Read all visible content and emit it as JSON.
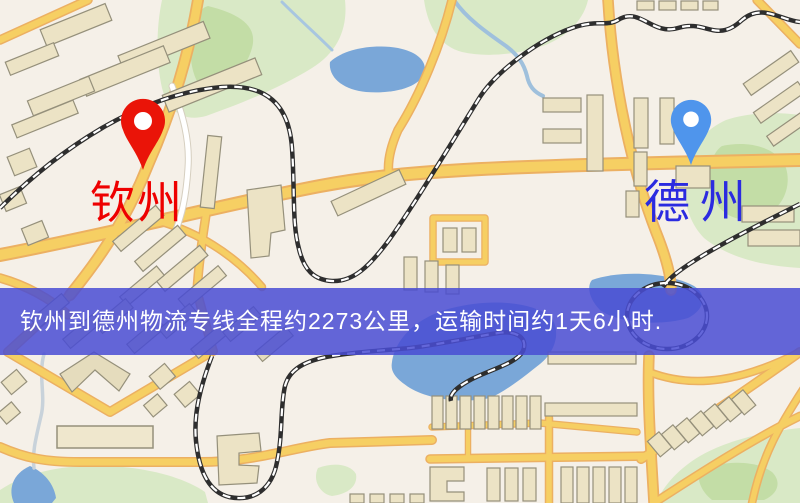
{
  "banner": {
    "text": "钦州到德州物流专线全程约2273公里，运输时间约1天6小时."
  },
  "route": {
    "origin": "钦州",
    "destination": "德州",
    "distance": "约2273公里",
    "duration": "约1天6小时"
  },
  "markers": {
    "origin": {
      "label": "钦州",
      "pin_color": "#ea1408",
      "label_color": "#ee0000"
    },
    "destination": {
      "label": "德州",
      "pin_color": "#4f95ec",
      "label_color": "#2b2be0"
    }
  },
  "colors": {
    "background": "#f5f0e8",
    "road_fill": "#f6cf63",
    "road_casing": "#ecb062",
    "park": "#d9e9c6",
    "park_dark": "#c3dda6",
    "water": "#7aa7d8",
    "building": "#ece3c5",
    "railway": "#2e2e2e",
    "banner_bg": "rgba(73,76,211,0.85)",
    "banner_text": "#ffffff"
  }
}
